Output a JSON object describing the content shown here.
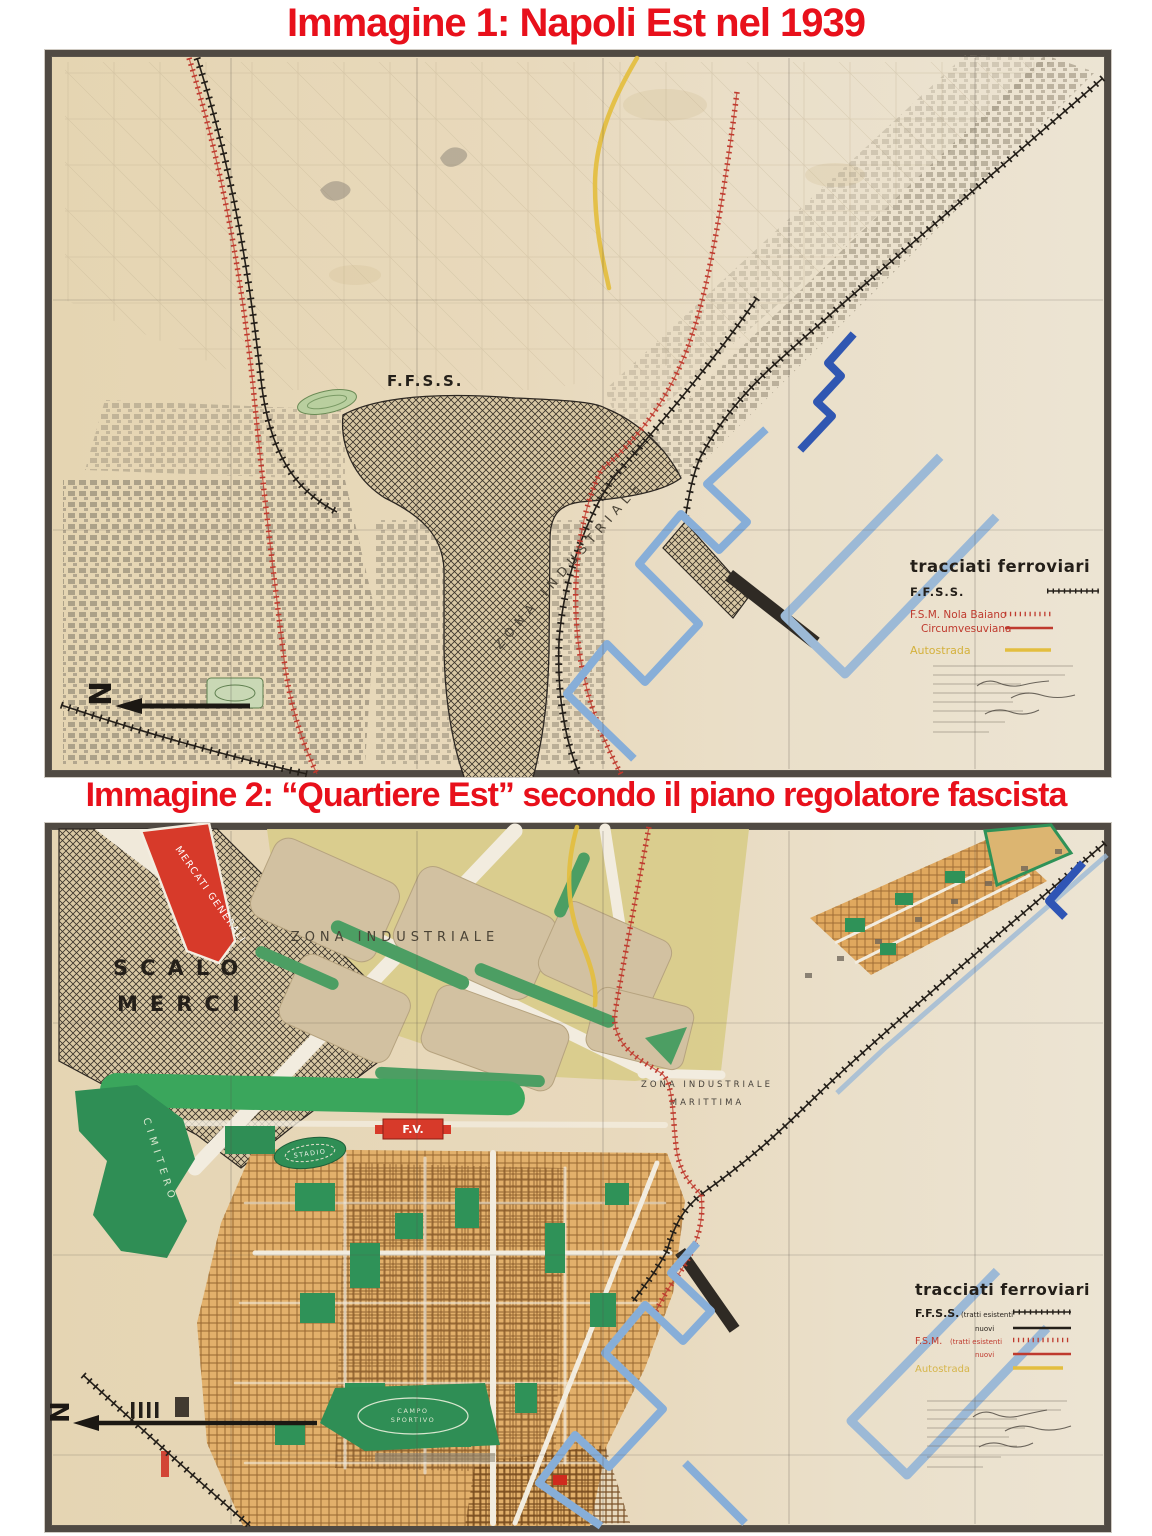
{
  "figure1": {
    "title": "Immagine 1: Napoli Est nel 1939",
    "title_color": "#e8101b",
    "map_labels": {
      "ffss": "F.F.S.S.",
      "zona_industriale": "ZONA INDUSTRIALE",
      "north": "N"
    },
    "legend": {
      "title": "tracciati ferroviari",
      "ffss": "F.F.S.S.",
      "fsm": "F.S.M. Nola Baiano",
      "circumvesuviana": "Circumvesuviana",
      "autostrada": "Autostrada",
      "colors": {
        "ffss": "#241f19",
        "fsm": "#bf3a2e",
        "autostrada": "#d4b13c"
      }
    }
  },
  "figure2": {
    "title": "Immagine 2: “Quartiere Est” secondo il piano regolatore fascista",
    "title_color": "#e8101b",
    "map_labels": {
      "mercati_generali": "MERCATI GENERALI",
      "scalo": "SCALO",
      "merci": "MERCI",
      "zona_industriale": "ZONA INDUSTRIALE",
      "zona_marittima_1": "ZONA INDUSTRIALE",
      "zona_marittima_2": "MARITTIMA",
      "stadio": "STADIO",
      "cimitero": "CIMITERO",
      "fv": "F.V.",
      "campo_1": "CAMPO",
      "campo_2": "SPORTIVO",
      "north": "N"
    },
    "legend": {
      "title": "tracciati ferroviari",
      "ffss": "F.F.S.S.",
      "ffss_esistenti": "(tratti esistenti",
      "ffss_nuovi": "nuovi",
      "fsm": "F.S.M.",
      "fsm_esistenti": "(tratti esistenti",
      "fsm_nuovi": "nuovi",
      "autostrada": "Autostrada",
      "colors": {
        "ffss": "#241f19",
        "fsm": "#bf3a2e",
        "autostrada": "#d4b13c"
      }
    }
  }
}
